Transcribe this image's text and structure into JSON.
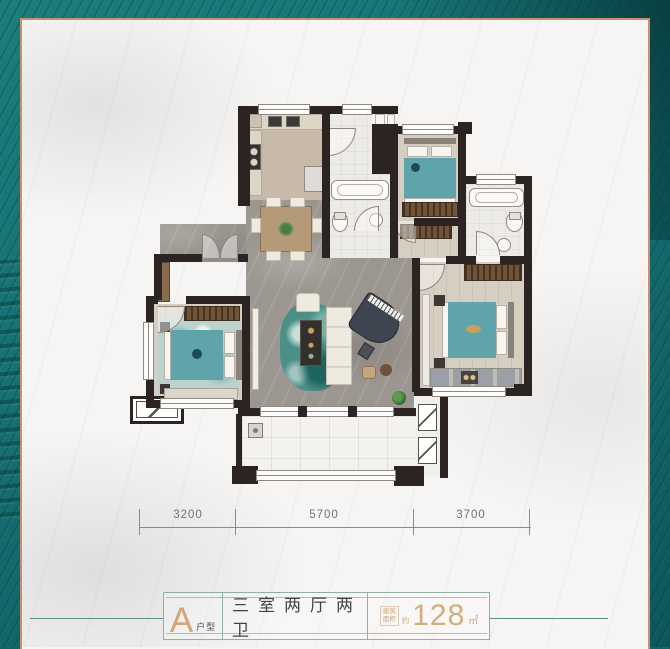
{
  "frame": {
    "teal_background": "#11666a",
    "copper_border": "#c98f6f",
    "card_marble": "#f6f5f3"
  },
  "dimensions": {
    "d1": "3200",
    "d2": "5700",
    "d3": "3700"
  },
  "footer": {
    "letter": "A",
    "letter_label": "户型",
    "title": "三室两厅两卫",
    "area_line1": "建筑",
    "area_line2": "面积",
    "area_about": "约",
    "area_value": "128",
    "area_unit": "㎡"
  },
  "colors": {
    "wall": "#2b2422",
    "bed_teal": "#5fa3ab",
    "rug_teal": "#4b8f88",
    "accent_gold": "#d3a676",
    "footer_line": "#5e8e85",
    "wardrobe_brown": "#70543a"
  }
}
